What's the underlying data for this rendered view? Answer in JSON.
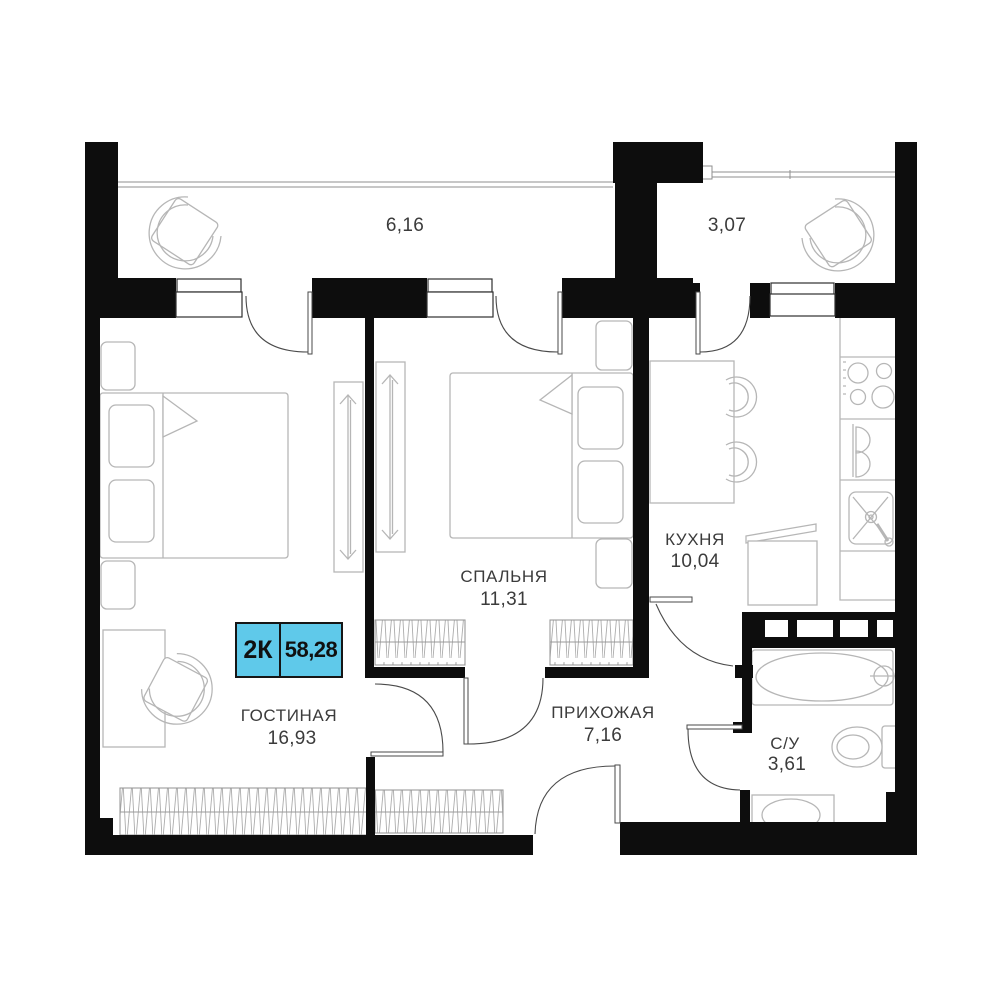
{
  "plan_summary": {
    "type_label": "2К",
    "total_area": "58,28"
  },
  "rooms": [
    {
      "key": "living",
      "name": "ГОСТИНАЯ",
      "area": "16,93"
    },
    {
      "key": "bedroom",
      "name": "СПАЛЬНЯ",
      "area": "11,31"
    },
    {
      "key": "kitchen",
      "name": "КУХНЯ",
      "area": "10,04"
    },
    {
      "key": "hallway",
      "name": "ПРИХОЖАЯ",
      "area": "7,16"
    },
    {
      "key": "bathroom",
      "name": "С/У",
      "area": "3,61"
    }
  ],
  "balconies": [
    {
      "key": "balcony-left",
      "area": "6,16"
    },
    {
      "key": "balcony-right",
      "area": "3,07"
    }
  ],
  "colors": {
    "wall": "#0d0d0d",
    "furniture_stroke": "#b6b6b6",
    "label_text": "#3b3b3b",
    "badge_fill": "#5fc9ea"
  }
}
